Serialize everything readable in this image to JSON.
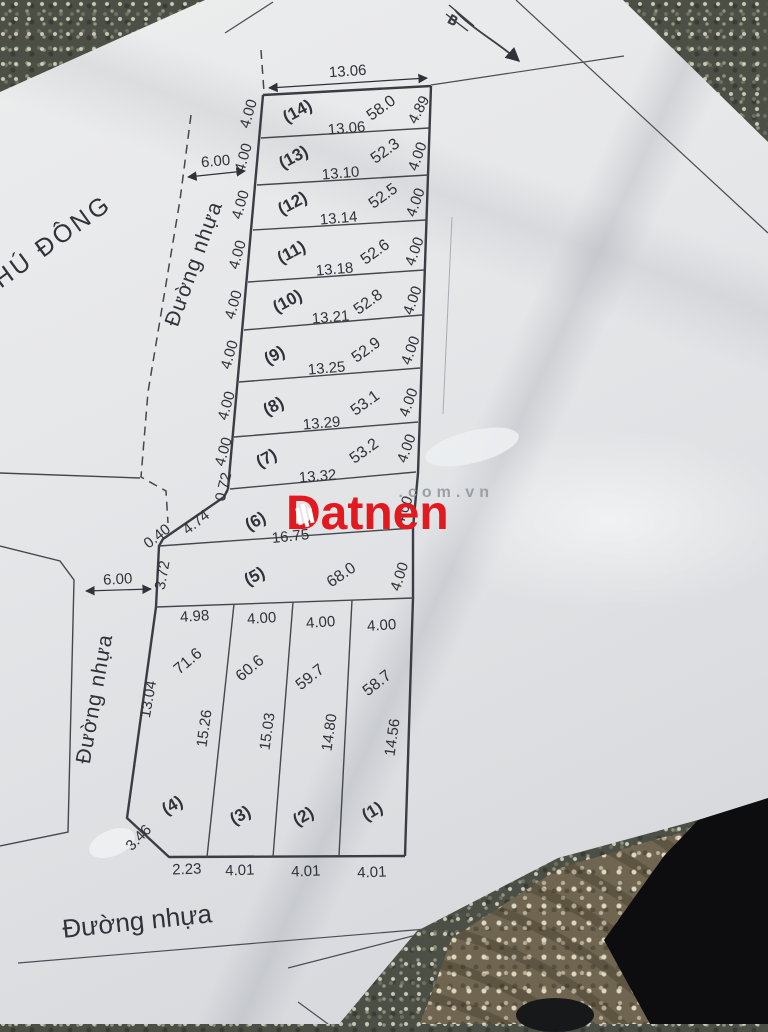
{
  "watermark": {
    "brand": "Datnen",
    "suffix": ".com.vn",
    "brand_color": "#e2191f"
  },
  "map": {
    "north": "B",
    "place": "HÚ ĐÔNG",
    "top_dim": "13.06",
    "roads": {
      "top_name": "Đường nhựa",
      "top_width": "6.00",
      "left_name": "Đường nhựa",
      "left_width": "6.00",
      "bottom_name": "Đường nhựa"
    },
    "strip_lots": [
      {
        "no": "(14)",
        "area": "58.0",
        "left": "4.00",
        "right": "4.89",
        "bottom": "13.06"
      },
      {
        "no": "(13)",
        "area": "52.3",
        "left": "4.00",
        "right": "4.00",
        "bottom": "13.10"
      },
      {
        "no": "(12)",
        "area": "52.5",
        "left": "4.00",
        "right": "4.00",
        "bottom": "13.14"
      },
      {
        "no": "(11)",
        "area": "52.6",
        "left": "4.00",
        "right": "4.00",
        "bottom": "13.18"
      },
      {
        "no": "(10)",
        "area": "52.8",
        "left": "4.00",
        "right": "4.00",
        "bottom": "13.21"
      },
      {
        "no": "(9)",
        "area": "52.9",
        "left": "4.00",
        "right": "4.00",
        "bottom": "13.25"
      },
      {
        "no": "(8)",
        "area": "53.1",
        "left": "4.00",
        "right": "4.00",
        "bottom": "13.29"
      },
      {
        "no": "(7)",
        "area": "53.2",
        "left": "4.00",
        "right": "4.00",
        "bottom": "13.32"
      }
    ],
    "lot6": {
      "no": "(6)",
      "bottom": "16.75",
      "edge1": "0.72",
      "edge2": "4.74",
      "edge3": "0.40",
      "right": "4.00"
    },
    "lot5": {
      "no": "(5)",
      "area": "68.0",
      "left": "3.72",
      "right": "4.00"
    },
    "block": {
      "top_widths": [
        "4.98",
        "4.00",
        "4.00",
        "4.00"
      ],
      "left_len": "13.04",
      "corner": "3.46",
      "bottom_widths": [
        "2.23",
        "4.01",
        "4.01",
        "4.01"
      ],
      "lots": [
        {
          "no": "(4)",
          "area": "71.6",
          "side": "15.26"
        },
        {
          "no": "(3)",
          "area": "60.6",
          "side": "15.03"
        },
        {
          "no": "(2)",
          "area": "59.7",
          "side": "14.80"
        },
        {
          "no": "(1)",
          "area": "58.7",
          "side": "14.56"
        }
      ]
    }
  }
}
